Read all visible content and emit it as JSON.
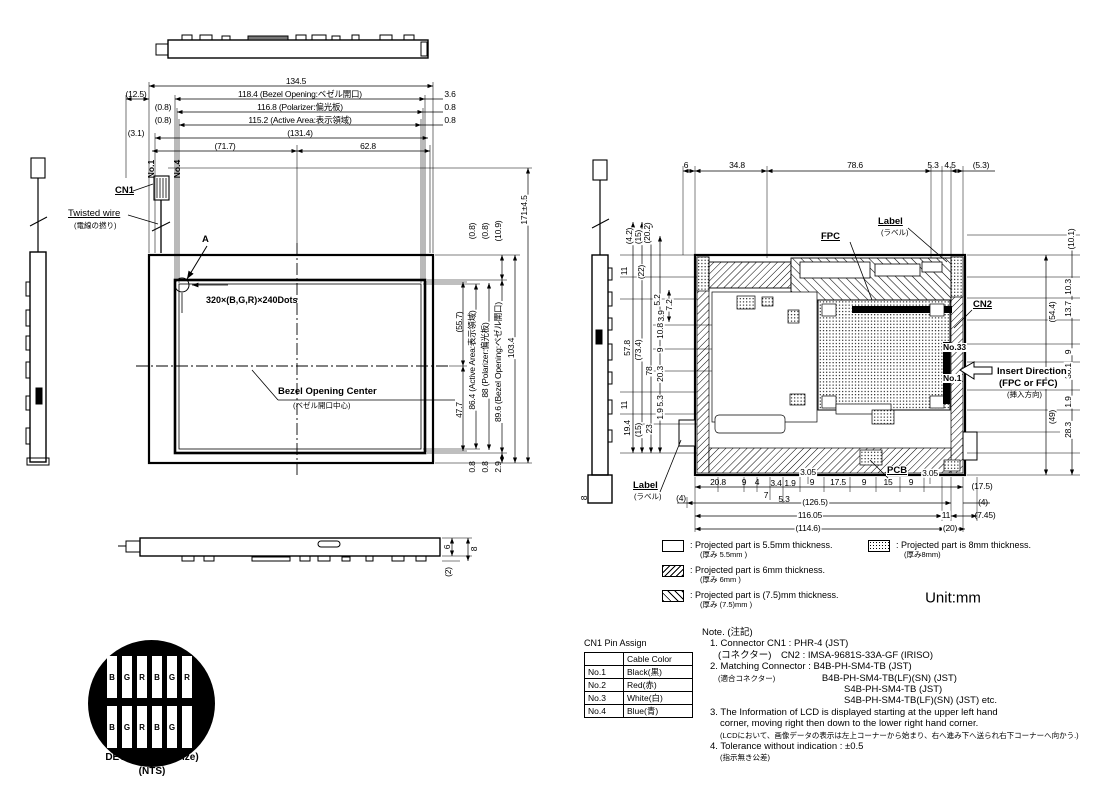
{
  "front_view": {
    "dims_top": [
      "134.5",
      "(12.5)",
      "118.4 (Bezel Opening:ベゼル開口)",
      "3.6",
      "(0.8)",
      "116.8 (Polarizer:偏光板)",
      "0.8",
      "(0.8)",
      "115.2 (Active Area:表示領域)",
      "0.8",
      "(3.1)",
      "(131.4)",
      "(71.7)",
      "62.8"
    ],
    "dims_right": [
      "(0.8)",
      "(0.8)",
      "(10.9)",
      "171±4.5",
      "(55.7)",
      "86.4 (Active Area:表示領域)",
      "88 (Polarizer:偏光板)",
      "89.6 (Bezel Opening:ベゼル開口)",
      "103.4",
      "47.7",
      "0.8",
      "0.8",
      "2.9"
    ],
    "labels": {
      "no1": "No.1",
      "no4": "No.4",
      "cn1": "CN1",
      "twisted": "Twisted wire",
      "twisted_jp": "(電線の撚り)",
      "a": "A",
      "dots": "320×(B,G,R)×240Dots",
      "bezel_center": "Bezel Opening Center",
      "bezel_center_jp": "(ベゼル開口中心)"
    }
  },
  "bottom_view": {
    "dims": [
      "6",
      "8",
      "(2)"
    ]
  },
  "side_view_right": {
    "dim": "8"
  },
  "rear_view": {
    "dims_top": [
      "6",
      "34.8",
      "78.6",
      "5.3",
      "4.5",
      "(5.3)"
    ],
    "dims_left": [
      "(4.2)",
      "(15)",
      "(20.2)",
      "11",
      "(22)",
      "5.2",
      "7.2",
      "3.9",
      "10.8",
      "9",
      "57.8",
      "(73.4)",
      "78",
      "20.3",
      "5.3",
      "1.9",
      "11",
      "19.4",
      "(15)",
      "23"
    ],
    "dims_right": [
      "(10.1)",
      "10.3",
      "13.7",
      "(54.4)",
      "9",
      "30.1",
      "1.9",
      "(49)",
      "28.3"
    ],
    "dims_bottom": [
      "3.05",
      "3.05",
      "20.8",
      "9",
      "4",
      "3.4",
      "1.9",
      "9",
      "17.5",
      "9",
      "15",
      "9",
      "(17.5)",
      "7",
      "5.3",
      "(4)",
      "(126.5)",
      "(4)",
      "116.05",
      "11",
      "(7.45)",
      "(114.6)",
      "(20)"
    ],
    "labels": {
      "fpc": "FPC",
      "label_top": "Label",
      "label_top_jp": "(ラベル)",
      "cn2": "CN2",
      "no33": "No.33",
      "no1": "No.1",
      "insert1": "Insert Direction",
      "insert2": "(FPC or FFC)",
      "insert3": "(挿入方向)",
      "pcb": "PCB",
      "label_bottom": "Label",
      "label_bottom_jp": "(ラベル)"
    }
  },
  "legend": {
    "items": [
      {
        "text": ": Projected part is 5.5mm thickness.",
        "sub": "(厚み 5.5mm )"
      },
      {
        "text": ": Projected part is 6mm thickness.",
        "sub": "(厚み 6mm )"
      },
      {
        "text": ": Projected part is (7.5)mm thickness.",
        "sub": "(厚み (7.5)mm )"
      },
      {
        "text": ": Projected part is 8mm thickness.",
        "sub": "(厚み8mm)"
      }
    ],
    "unit": "Unit:mm"
  },
  "pin_table": {
    "title": "CN1 Pin Assign",
    "col_header": "Cable Color",
    "rows": [
      {
        "pin": "No.1",
        "color": "Black(黒)"
      },
      {
        "pin": "No.2",
        "color": "Red(赤)"
      },
      {
        "pin": "No.3",
        "color": "White(白)"
      },
      {
        "pin": "No.4",
        "color": "Blue(青)"
      }
    ]
  },
  "note": {
    "lines": [
      "Note. (注記)",
      "1. Connector CN1 : PHR-4 (JST)",
      "(コネクター)　CN2 : IMSA-9681S-33A-GF (IRISO)",
      "2. Matching Connector : B4B-PH-SM4-TB (JST)",
      "(適合コネクター)",
      "B4B-PH-SM4-TB(LF)(SN) (JST)",
      "S4B-PH-SM4-TB (JST)",
      "S4B-PH-SM4-TB(LF)(SN) (JST)    etc.",
      "3. The Information of LCD is displayed starting at the upper left hand",
      "corner, moving right then down to the lower right hand corner.",
      "(LCDにおいて、画像データの表示は左上コーナーから始まり、右へ進み下へ送られ右下コーナーへ向かう.)",
      "4. Tolerance without indication : ±0.5",
      "(指示無き公差)"
    ]
  },
  "detail": {
    "title": "DETAIL A (Dot Size)",
    "subtitle": "(NTS)",
    "r1": [
      "B",
      "G",
      "R",
      "B",
      "G",
      "R"
    ],
    "r2": [
      "B",
      "G",
      "R",
      "B",
      "G"
    ]
  },
  "colors": {
    "ink": "#000000",
    "paper": "#ffffff"
  }
}
